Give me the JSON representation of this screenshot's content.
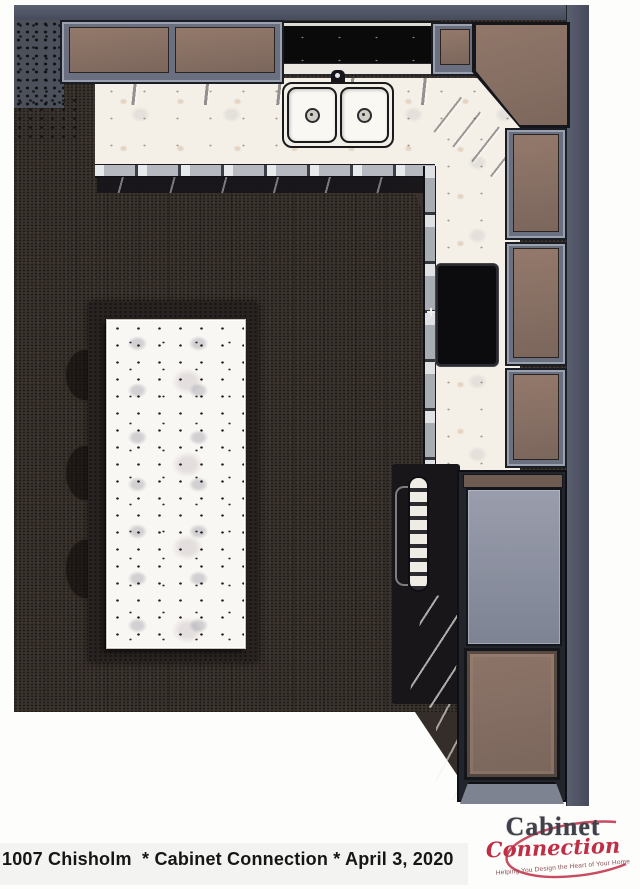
{
  "document": {
    "caption": "1007 Chisholm  * Cabinet Connection * April 3, 2020"
  },
  "logo": {
    "word1": "Cabinet",
    "word2": "Connection",
    "tagline": "Helping You Design the Heart of Your Home",
    "swoosh_color": "#c23750",
    "word1_color": "#41414b",
    "word2_color": "#c02e46"
  },
  "rendering": {
    "subject": "overhead kitchen cabinet design rendering",
    "colors": {
      "floor": "#3a322d",
      "wall": "#4d5263",
      "cabinet_top": "#8b7368",
      "cabinet_frame": "#6b7080",
      "countertop_marble": "#f5f0e7",
      "island_marble": "#f9f7f3",
      "cooktop_black": "#0c0c0e",
      "refrigerator_gray": "#8b8fa0"
    }
  }
}
